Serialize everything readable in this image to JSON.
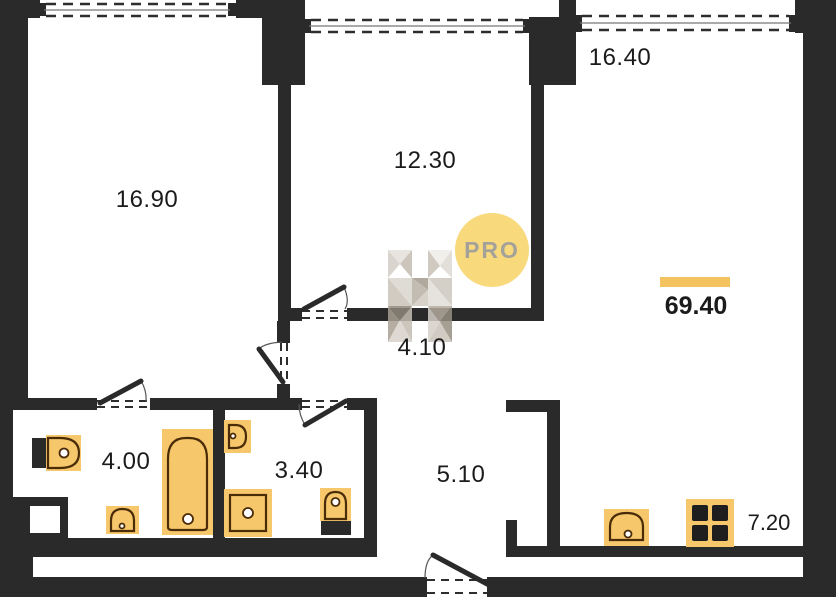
{
  "plan": {
    "rooms": [
      {
        "id": "room-16-90",
        "area": "16.90"
      },
      {
        "id": "room-12-30",
        "area": "12.30"
      },
      {
        "id": "room-16-40",
        "area": "16.40"
      },
      {
        "id": "hall-4-10",
        "area": "4.10"
      },
      {
        "id": "bathroom-4-00",
        "area": "4.00"
      },
      {
        "id": "bathroom-3-40",
        "area": "3.40"
      },
      {
        "id": "hallway-5-10",
        "area": "5.10"
      },
      {
        "id": "kitchen-7-20",
        "area": "7.20"
      }
    ],
    "total_area": "69.40"
  },
  "watermark": {
    "badge": "PRO"
  },
  "colors": {
    "wall": "#2a2a2a",
    "label": "#1b1b1b",
    "fixture-fill": "#F6C76B",
    "fixture-stroke": "#4a2c08",
    "accent-bar": "#F2C35E",
    "badge-fill": "#F8D97B",
    "badge-text": "#A3A19A",
    "window-line": "#777777",
    "dash": "#2e2e2e"
  }
}
